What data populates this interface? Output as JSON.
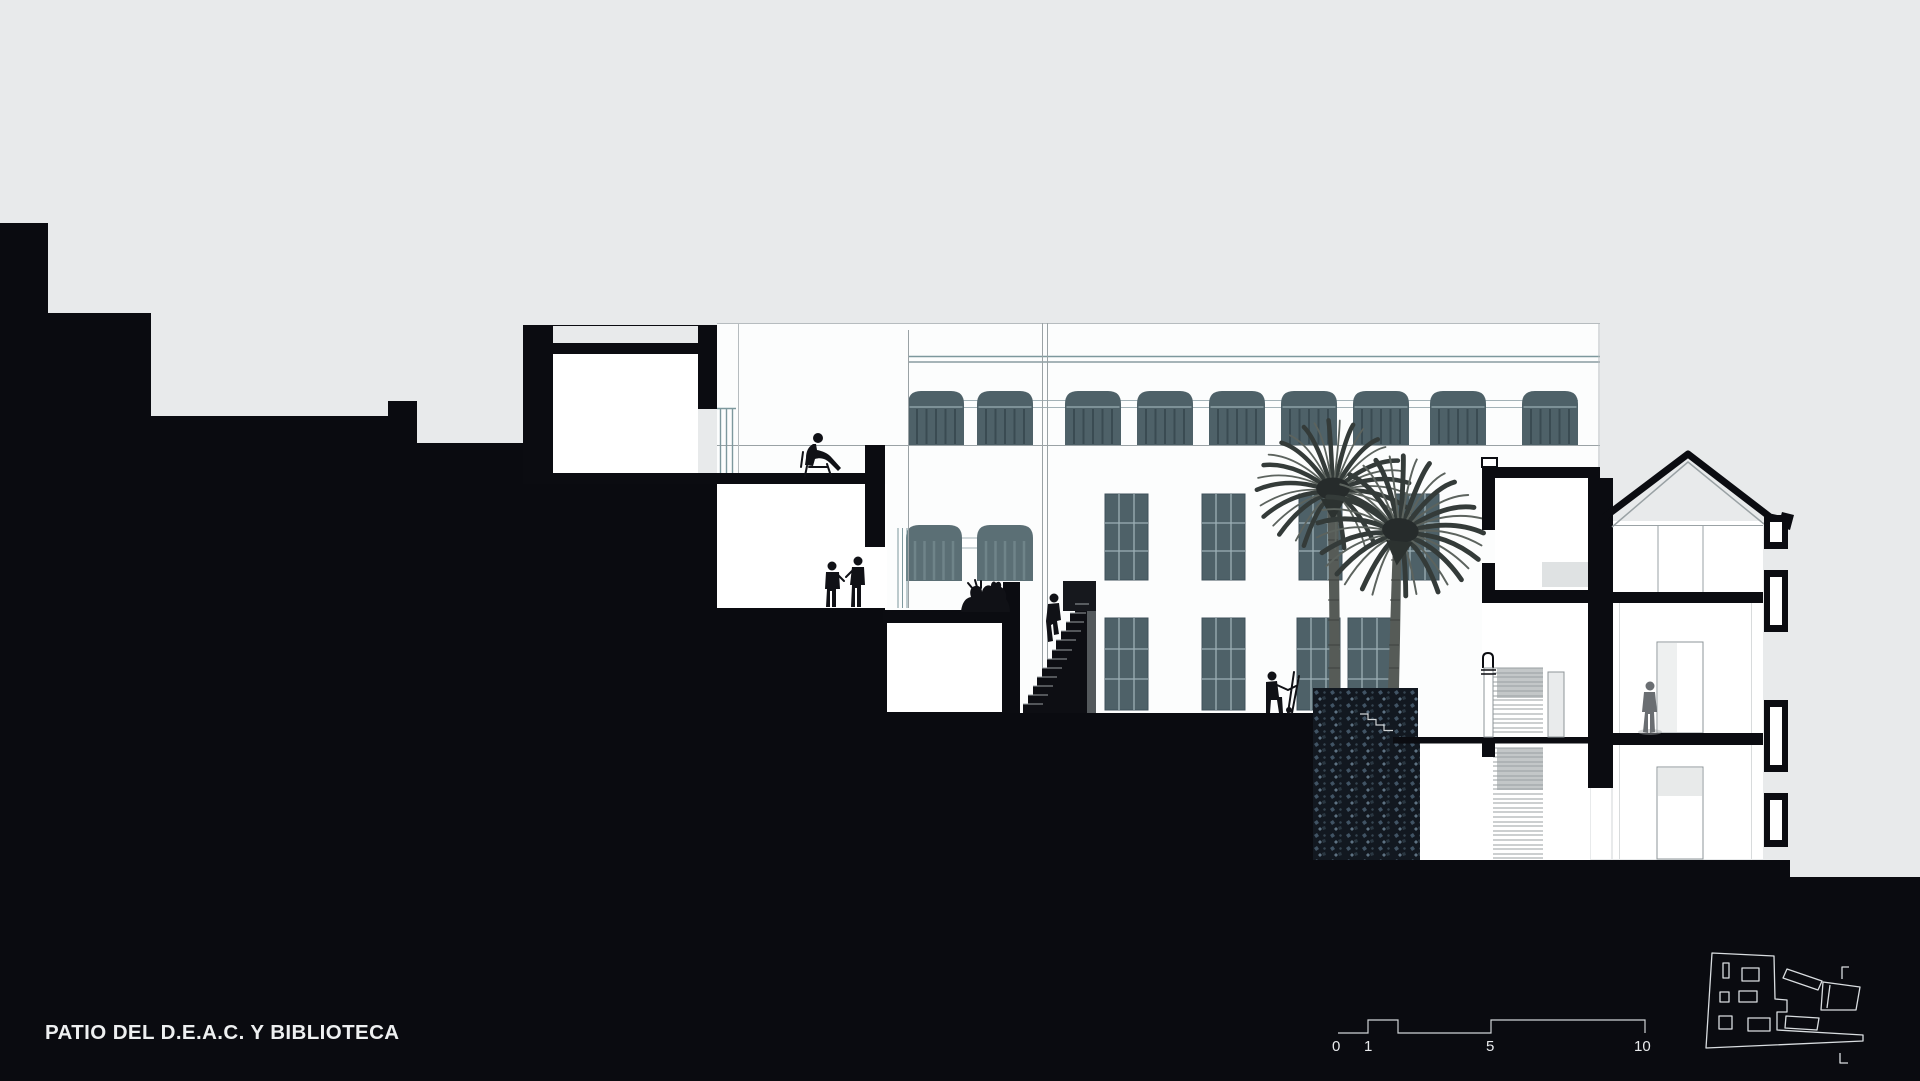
{
  "drawing": {
    "title": "PATIO DEL D.E.A.C. Y BIBLIOTECA",
    "scale_bar": {
      "labels": [
        "0",
        "1",
        "5",
        "10"
      ]
    },
    "palette": {
      "background_gray": "#e8eaeb",
      "section_black": "#0b0c11",
      "window_teal": "#4e6168",
      "line_gray": "#9aa2a5",
      "paper_white": "#fcfdfd"
    },
    "elements": {
      "sections": [
        "library-tower",
        "terrace-rooms",
        "main-elevation",
        "courtyard-stair",
        "stair-tower",
        "townhouse"
      ],
      "vegetation": [
        "palm-tree",
        "palm-tree"
      ],
      "figures": [
        "person-seated-on-chair",
        "two-people-talking",
        "group-seated-reading",
        "person-climbing-stair",
        "person-with-handcart",
        "person-in-doorway"
      ],
      "icons": [
        "site-key-plan-icon",
        "scale-bar"
      ]
    }
  }
}
